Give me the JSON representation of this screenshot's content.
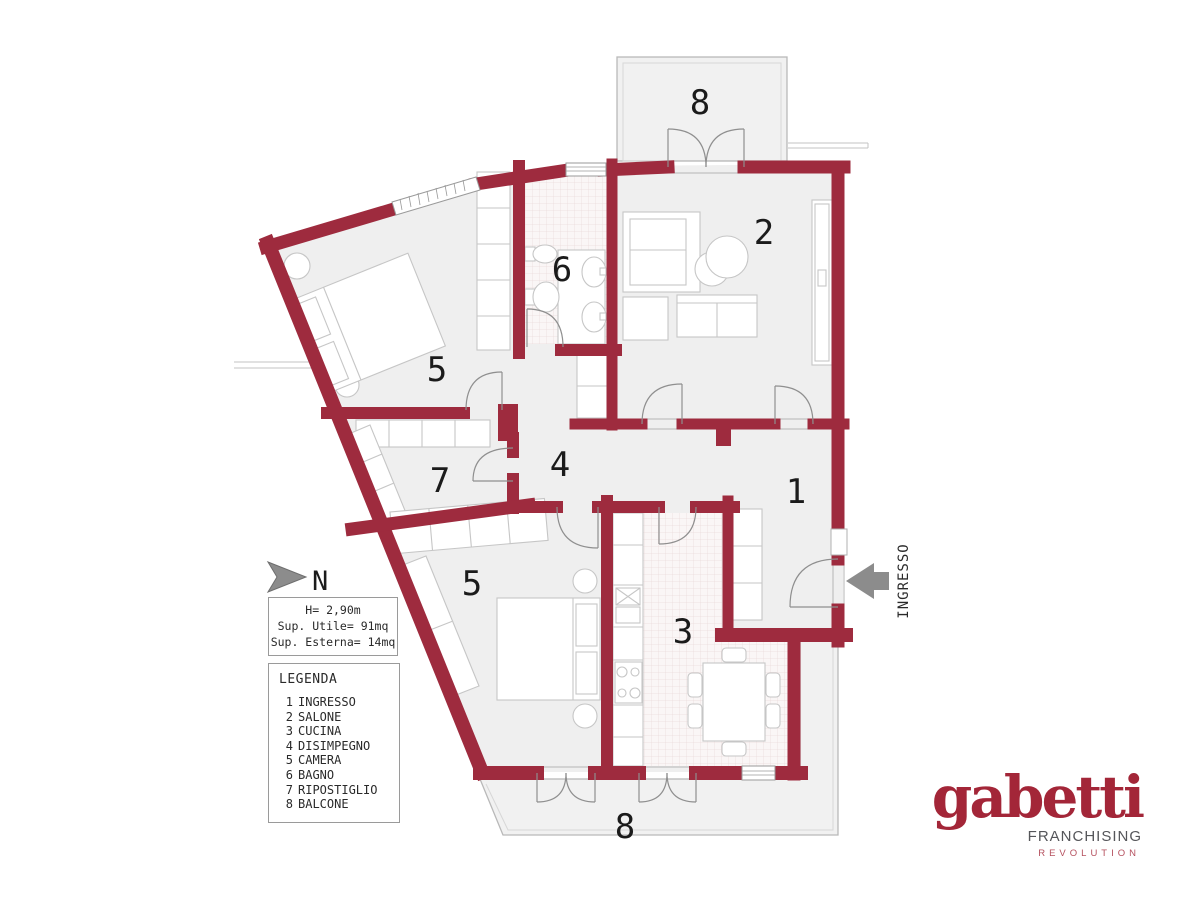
{
  "plan": {
    "north_label": "N",
    "entrance_label": "INGRESSO",
    "labels": [
      {
        "room": "balcone-nord",
        "text": "8"
      },
      {
        "room": "salone",
        "text": "2"
      },
      {
        "room": "bagno",
        "text": "6"
      },
      {
        "room": "camera-1",
        "text": "5"
      },
      {
        "room": "disimpegno",
        "text": "4"
      },
      {
        "room": "ripostiglio",
        "text": "7"
      },
      {
        "room": "ingresso",
        "text": "1"
      },
      {
        "room": "camera-2",
        "text": "5"
      },
      {
        "room": "cucina",
        "text": "3"
      },
      {
        "room": "balcone-sud",
        "text": "8"
      }
    ]
  },
  "info_box": {
    "height": "H= 2,90m",
    "usable_area": "Sup. Utile= 91mq",
    "external_area": "Sup. Esterna= 14mq"
  },
  "legend": {
    "title": "LEGENDA",
    "items": [
      {
        "num": "1",
        "name": "INGRESSO"
      },
      {
        "num": "2",
        "name": "SALONE"
      },
      {
        "num": "3",
        "name": "CUCINA"
      },
      {
        "num": "4",
        "name": "DISIMPEGNO"
      },
      {
        "num": "5",
        "name": "CAMERA"
      },
      {
        "num": "6",
        "name": "BAGNO"
      },
      {
        "num": "7",
        "name": "RIPOSTIGLIO"
      },
      {
        "num": "8",
        "name": "BALCONE"
      }
    ]
  },
  "logo": {
    "brand": "gabetti",
    "sub1": "FRANCHISING",
    "sub2": "REVOLUTION"
  },
  "colors": {
    "wall": "#9e2b3e",
    "floor": "#efefef",
    "balcony": "#f1f1f1",
    "logo_red": "#a32638",
    "franchising_gray": "#55565a",
    "revolution_red": "#b5505e",
    "arrow_gray": "#8c8c8c"
  }
}
